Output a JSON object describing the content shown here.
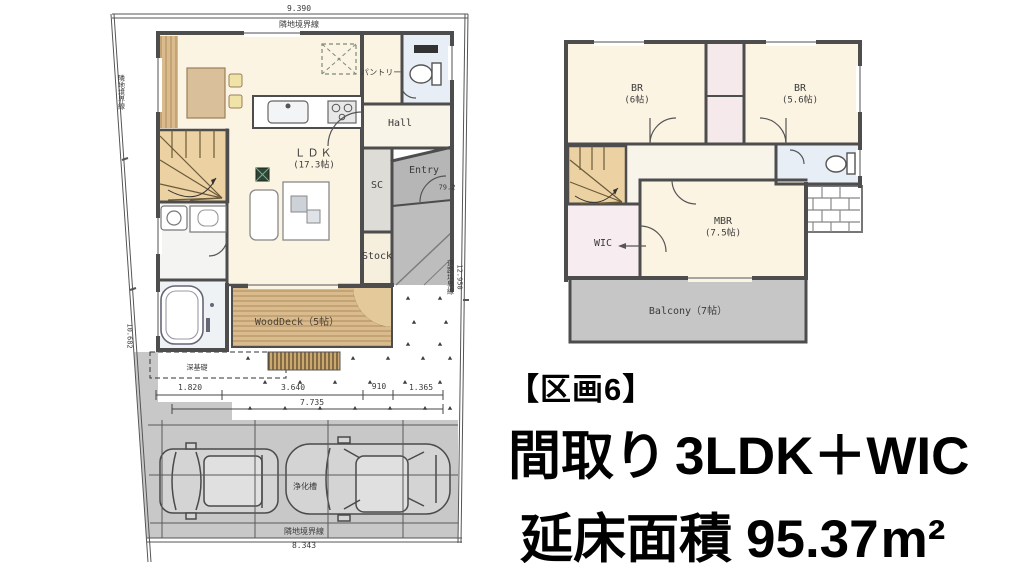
{
  "caption": {
    "lot": "【区画6】",
    "layout_label": "間取り",
    "layout_value": "3LDK＋WIC",
    "area_label": "延床面積",
    "area_value": "95.37",
    "area_unit": "m²"
  },
  "floor1": {
    "rooms": {
      "ldk_name": "ＬＤＫ",
      "ldk_size": "(17.3帖)",
      "pantry": "パントリー",
      "hall": "Hall",
      "entry": "Entry",
      "shoe_closet": "SC",
      "stock": "Stock",
      "wood_deck": "WoodDeck（5帖）"
    },
    "site": {
      "septic_tank": "浄化槽",
      "deep_foundation": "深基礎",
      "boundary_top": "隣地境界線",
      "boundary_bottom": "隣地境界線",
      "boundary_left": "隣地境界線",
      "boundary_right": "道路境界線"
    },
    "dimensions": {
      "top": "9.390",
      "bottom": "8.343",
      "right": "12.950",
      "right_offset": "79.2",
      "left_offset": "10.682",
      "row1": [
        "1.820",
        "3.640",
        "910",
        "1.365"
      ],
      "row_total": "7.735"
    }
  },
  "floor2": {
    "rooms": {
      "br1_name": "BR",
      "br1_size": "(6帖)",
      "br2_name": "BR",
      "br2_size": "(5.6帖)",
      "mbr_name": "MBR",
      "mbr_size": "(7.5帖)",
      "wic": "WIC",
      "balcony": "Balcony（7帖）"
    }
  },
  "colors": {
    "wall": "#4d4d4d",
    "floor_cream": "#fcf4e3",
    "wood": "#d9bb8e",
    "stairs": "#ecd2a2",
    "gray_site": "#c8c8c8",
    "water_blue": "#e8eef6",
    "closet_pink": "#f5e9ec"
  }
}
